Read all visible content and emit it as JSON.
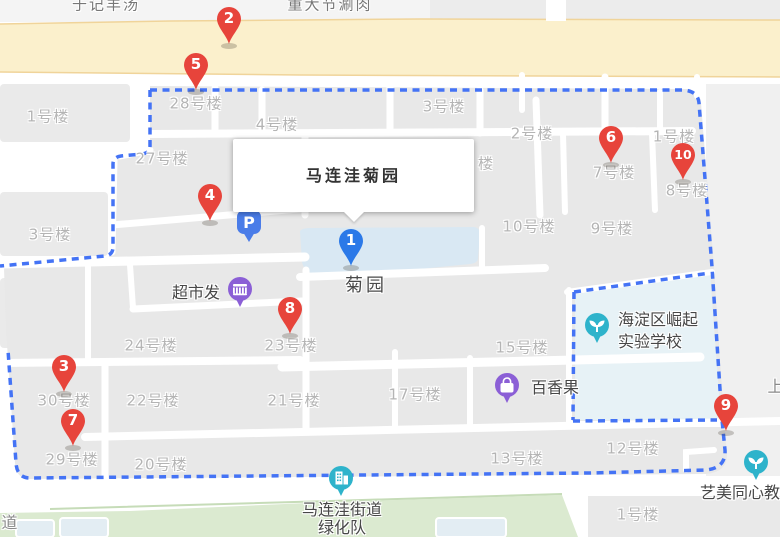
{
  "map": {
    "info_window": {
      "title": "马连洼菊园"
    },
    "markers": [
      {
        "n": "1",
        "color": "blue",
        "x": 351,
        "y": 241
      },
      {
        "n": "2",
        "color": "red",
        "x": 229,
        "y": 19
      },
      {
        "n": "3",
        "color": "red",
        "x": 64,
        "y": 367
      },
      {
        "n": "4",
        "color": "red",
        "x": 210,
        "y": 196
      },
      {
        "n": "5",
        "color": "red",
        "x": 196,
        "y": 65
      },
      {
        "n": "6",
        "color": "red",
        "x": 611,
        "y": 138
      },
      {
        "n": "7",
        "color": "red",
        "x": 73,
        "y": 421
      },
      {
        "n": "8",
        "color": "red",
        "x": 290,
        "y": 309
      },
      {
        "n": "9",
        "color": "red",
        "x": 726,
        "y": 406
      },
      {
        "n": "10",
        "color": "red",
        "x": 683,
        "y": 155
      }
    ],
    "pois": [
      {
        "glyph": "parking",
        "x": 249,
        "y": 222,
        "name": "parking-icon"
      },
      {
        "glyph": "shop",
        "x": 240,
        "y": 289,
        "name": "supermarket-icon"
      },
      {
        "glyph": "bag",
        "x": 507,
        "y": 385,
        "name": "shopping-bag-icon"
      },
      {
        "glyph": "sprout",
        "x": 597,
        "y": 325,
        "name": "school-icon"
      },
      {
        "glyph": "sprout",
        "x": 756,
        "y": 462,
        "name": "education-icon"
      },
      {
        "glyph": "building",
        "x": 341,
        "y": 478,
        "name": "office-icon"
      }
    ],
    "labels": [
      {
        "t": "于记羊汤",
        "x": 106,
        "y": 4,
        "cls": "street-top",
        "name": "restaurant-label"
      },
      {
        "t": "重大节涮肉",
        "x": 330,
        "y": 4,
        "cls": "street-top",
        "name": "restaurant-label"
      },
      {
        "t": "1号楼",
        "x": 48,
        "y": 116,
        "cls": "bld"
      },
      {
        "t": "28号楼",
        "x": 196,
        "y": 103,
        "cls": "bld"
      },
      {
        "t": "4号楼",
        "x": 277,
        "y": 124,
        "cls": "bld"
      },
      {
        "t": "3号楼",
        "x": 444,
        "y": 106,
        "cls": "bld"
      },
      {
        "t": "2号楼",
        "x": 532,
        "y": 133,
        "cls": "bld"
      },
      {
        "t": "1号楼",
        "x": 674,
        "y": 136,
        "cls": "bld"
      },
      {
        "t": "27号楼",
        "x": 162,
        "y": 158,
        "cls": "bld"
      },
      {
        "t": "楼",
        "x": 486,
        "y": 163,
        "cls": "bld"
      },
      {
        "t": "7号楼",
        "x": 614,
        "y": 172,
        "cls": "bld"
      },
      {
        "t": "8号楼",
        "x": 687,
        "y": 190,
        "cls": "bld"
      },
      {
        "t": "3号楼",
        "x": 50,
        "y": 234,
        "cls": "bld"
      },
      {
        "t": "10号楼",
        "x": 529,
        "y": 226,
        "cls": "bld"
      },
      {
        "t": "9号楼",
        "x": 612,
        "y": 228,
        "cls": "bld"
      },
      {
        "t": "菊园",
        "x": 366,
        "y": 284,
        "cls": "poi-lg",
        "name": "garden-label"
      },
      {
        "t": "超市发",
        "x": 196,
        "y": 291,
        "cls": "poi",
        "name": "supermarket-label"
      },
      {
        "t": "海淀区崛起",
        "x": 658,
        "y": 318,
        "cls": "poi",
        "name": "school-label-line1"
      },
      {
        "t": "实验学校",
        "x": 650,
        "y": 340,
        "cls": "poi",
        "name": "school-label-line2"
      },
      {
        "t": "24号楼",
        "x": 151,
        "y": 345,
        "cls": "bld"
      },
      {
        "t": "23号楼",
        "x": 291,
        "y": 345,
        "cls": "bld"
      },
      {
        "t": "15号楼",
        "x": 522,
        "y": 347,
        "cls": "bld"
      },
      {
        "t": "百香果",
        "x": 555,
        "y": 386,
        "cls": "poi",
        "name": "fruitshop-label"
      },
      {
        "t": "上",
        "x": 776,
        "y": 385,
        "cls": "street"
      },
      {
        "t": "30号楼",
        "x": 64,
        "y": 400,
        "cls": "bld"
      },
      {
        "t": "22号楼",
        "x": 153,
        "y": 400,
        "cls": "bld"
      },
      {
        "t": "21号楼",
        "x": 294,
        "y": 400,
        "cls": "bld"
      },
      {
        "t": "17号楼",
        "x": 415,
        "y": 394,
        "cls": "bld"
      },
      {
        "t": "29号楼",
        "x": 72,
        "y": 459,
        "cls": "bld"
      },
      {
        "t": "20号楼",
        "x": 161,
        "y": 464,
        "cls": "bld"
      },
      {
        "t": "13号楼",
        "x": 517,
        "y": 458,
        "cls": "bld"
      },
      {
        "t": "12号楼",
        "x": 633,
        "y": 448,
        "cls": "bld"
      },
      {
        "t": "艺美同心教育",
        "x": 748,
        "y": 491,
        "cls": "poi",
        "name": "education-label"
      },
      {
        "t": "马连洼街道",
        "x": 342,
        "y": 508,
        "cls": "poi",
        "name": "greening-team-label-line1"
      },
      {
        "t": "绿化队",
        "x": 342,
        "y": 526,
        "cls": "poi",
        "name": "greening-team-label-line2"
      },
      {
        "t": "1号楼",
        "x": 638,
        "y": 514,
        "cls": "bld"
      },
      {
        "t": "道",
        "x": 10,
        "y": 521,
        "cls": "street"
      }
    ],
    "colors": {
      "marker_red": "#e7443b",
      "marker_blue": "#2b79e8",
      "boundary_dash": "#4473f5",
      "road_fill": "#fbf0cc",
      "road_edge": "#f0d49a",
      "block_gray": "#e8e8e8",
      "pond_blue": "#d9e8f3",
      "school_fill": "#e7f2f6",
      "green_strip": "#dbead0",
      "poi_purple": "#8b5fd6",
      "poi_teal": "#2eb3cb",
      "parking_blue": "#4a7ce8"
    }
  }
}
